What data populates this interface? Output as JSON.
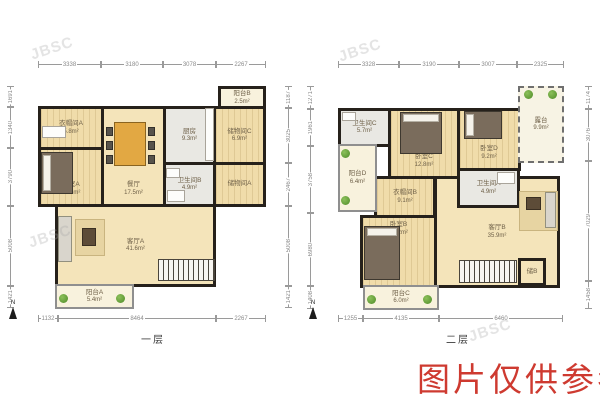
{
  "watermark": "JBSC",
  "disclaimer": "图片仅供参考",
  "north_label": "N",
  "colors": {
    "wall": "#26211b",
    "room_beige": "#f4e4ba",
    "room_gray": "#e9e8e3",
    "balcony_cream": "#f8f2dd",
    "disclaimer_red": "#ce3a30",
    "plant_green": "#4e8b28",
    "dimension_gray": "#8a8a8a"
  },
  "floor1": {
    "name": "一层",
    "dims_top": [
      "3338",
      "3180",
      "3078",
      "2267"
    ],
    "dims_bottom": [
      "1132",
      "8464",
      "2267"
    ],
    "dims_left": [
      "1691",
      "1340",
      "3790",
      "5008",
      "1421"
    ],
    "dims_right": [
      "1187",
      "3025",
      "2467",
      "5008",
      "1421"
    ],
    "rooms": {
      "balcony_b": {
        "label": "阳台B",
        "area": "2.5m²"
      },
      "cloakroom_a": {
        "label": "衣帽间A",
        "area": "5.8m²"
      },
      "bedroom_a": {
        "label": "卧室A",
        "area": "12.5m²"
      },
      "dining": {
        "label": "餐厅",
        "area": "17.5m²"
      },
      "kitchen": {
        "label": "厨房",
        "area": "9.3m²"
      },
      "storage_c": {
        "label": "储物间C",
        "area": "6.9m²"
      },
      "bath_b": {
        "label": "卫生间B",
        "area": "4.9m²"
      },
      "storage_a": {
        "label": "储物间A",
        "area": ""
      },
      "living_a": {
        "label": "客厅A",
        "area": "41.6m²"
      },
      "balcony_a": {
        "label": "阳台A",
        "area": "5.4m²"
      }
    }
  },
  "floor2": {
    "name": "二层",
    "dims_top": [
      "3328",
      "3190",
      "3007",
      "2325"
    ],
    "dims_bottom": [
      "1255",
      "4135",
      "6460"
    ],
    "dims_left": [
      "1271",
      "1961",
      "3758",
      "6980",
      "1408"
    ],
    "dims_right": [
      "1174",
      "3076",
      "7029",
      "1458"
    ],
    "rooms": {
      "terrace": {
        "label": "露台",
        "area": "9.9m²"
      },
      "bath_c": {
        "label": "卫生间C",
        "area": "5.7m²"
      },
      "balcony_d": {
        "label": "阳台D",
        "area": "6.4m²"
      },
      "bedroom_c": {
        "label": "卧室C",
        "area": "12.8m²"
      },
      "bedroom_d": {
        "label": "卧室D",
        "area": "9.2m²"
      },
      "cloakroom_b": {
        "label": "衣帽间B",
        "area": "9.1m²"
      },
      "bath_a": {
        "label": "卫生间A",
        "area": "4.9m²"
      },
      "bedroom_b": {
        "label": "卧室B",
        "area": "19.2m²"
      },
      "living_b": {
        "label": "客厅B",
        "area": "35.9m²"
      },
      "balcony_c": {
        "label": "阳台C",
        "area": "6.0m²"
      },
      "storage_b": {
        "label": "储B",
        "area": ""
      }
    }
  }
}
